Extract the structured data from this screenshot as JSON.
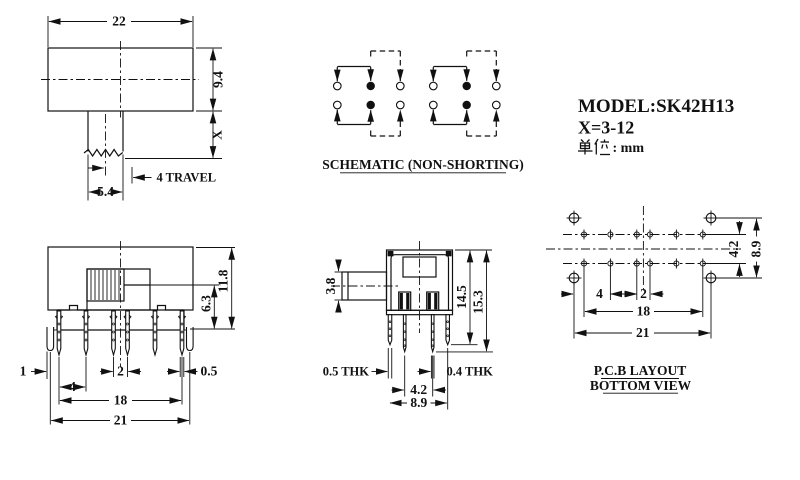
{
  "title_block": {
    "model": "MODEL:SK42H13",
    "x_range": "X=3-12",
    "unit_cjk": "单位",
    "unit_suffix": ": mm",
    "unit_full": "单位: mm"
  },
  "top_view": {
    "dim_width": "22",
    "dim_height": "9.4",
    "dim_stem": "X",
    "dim_travel": "4 TRAVEL",
    "dim_stem_width": "5.4"
  },
  "schematic": {
    "label": "SCHEMATIC (NON-SHORTING)"
  },
  "front_view": {
    "dim_total_height": "11.8",
    "dim_knob_height": "6.3",
    "dim_hook_width": "1",
    "dim_pitch_a": "4",
    "dim_pitch_b": "2",
    "dim_pin_width": "0.5",
    "dim_span_inner": "18",
    "dim_span_outer": "21"
  },
  "side_view": {
    "dim_knob_height": "3.8",
    "dim_height_inner": "14.5",
    "dim_height_outer": "15.3",
    "dim_thk_left": "0.5 THK",
    "dim_thk_right": "0.4 THK",
    "dim_pin_pitch": "4.2",
    "dim_pin_span": "8.9"
  },
  "pcb_view": {
    "dim_row_gap": "4.2",
    "dim_hole_gap": "8.9",
    "dim_pitch_a": "4",
    "dim_pitch_b": "2",
    "dim_span_inner": "18",
    "dim_span_outer": "21",
    "label_line1": "P.C.B LAYOUT",
    "label_line2": "BOTTOM VIEW"
  },
  "colors": {
    "ink": "#111111",
    "bg": "#ffffff"
  }
}
